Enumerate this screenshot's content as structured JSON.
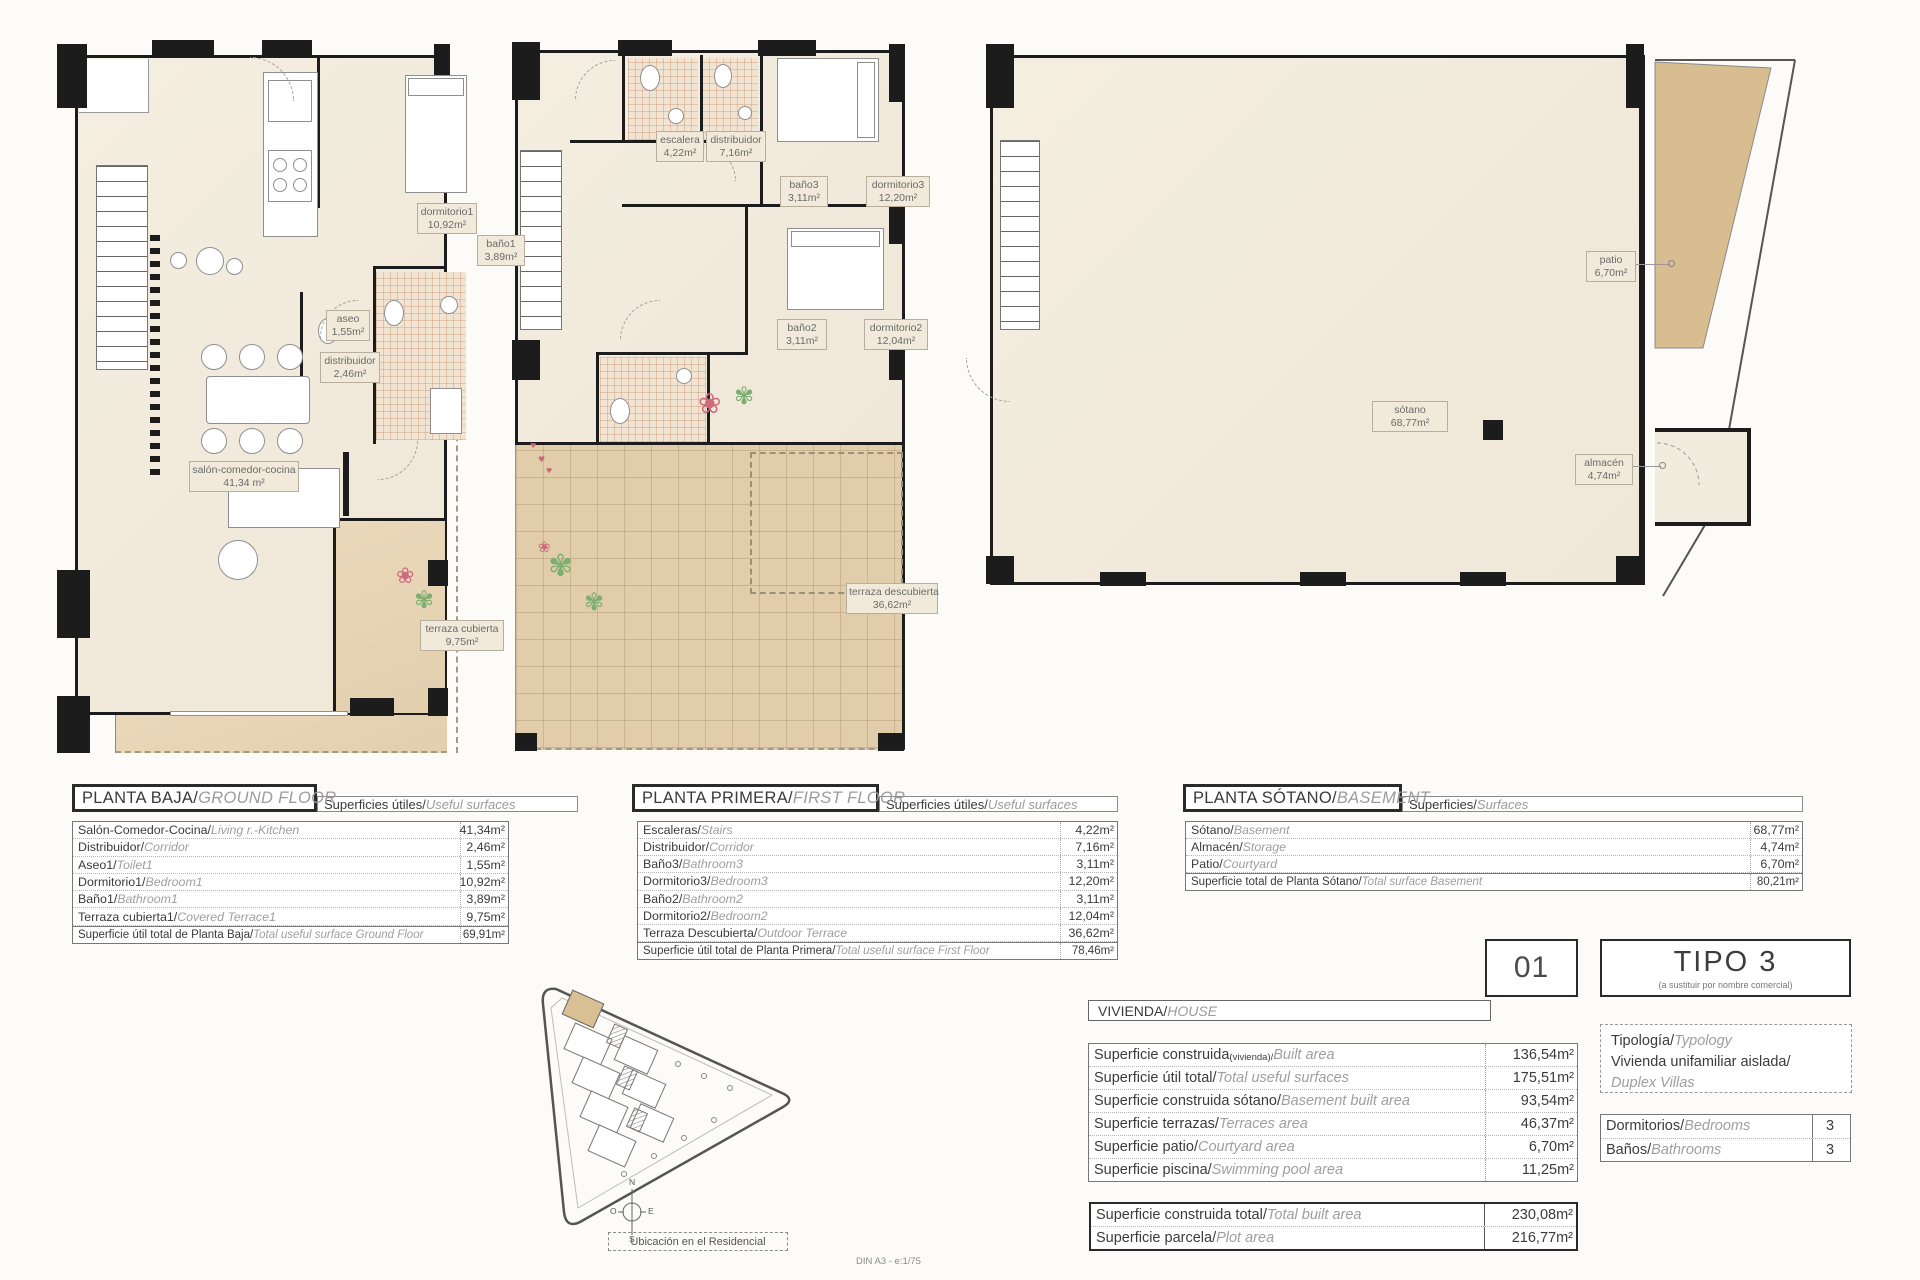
{
  "ground": {
    "title_es": "PLANTA BAJA/",
    "title_en": "GROUND FLOOR",
    "strip_es": "Superficies útiles/",
    "strip_en": "Useful surfaces",
    "labels": [
      {
        "name": "dormitorio1",
        "area": "10,92m²"
      },
      {
        "name": "baño1",
        "area": "3,89m²"
      },
      {
        "name": "aseo",
        "area": "1,55m²"
      },
      {
        "name": "distribuidor",
        "area": "2,46m²"
      },
      {
        "name": "salón-comedor-cocina",
        "area": "41,34 m²"
      },
      {
        "name": "terraza cubierta",
        "area": "9,75m²"
      }
    ],
    "rows": [
      {
        "es": "Salón-Comedor-Cocina/",
        "en": "Living r.-Kitchen",
        "value": "41,34m²"
      },
      {
        "es": "Distribuidor/",
        "en": "Corridor",
        "value": "2,46m²"
      },
      {
        "es": "Aseo1/",
        "en": "Toilet1",
        "value": "1,55m²"
      },
      {
        "es": "Dormitorio1/",
        "en": "Bedroom1",
        "value": "10,92m²"
      },
      {
        "es": "Baño1/",
        "en": "Bathroom1",
        "value": "3,89m²"
      },
      {
        "es": "Terraza cubierta1/",
        "en": "Covered Terrace1",
        "value": "9,75m²"
      }
    ],
    "total": {
      "es": "Superficie útil total de Planta Baja/",
      "en": "Total useful surface Ground Floor",
      "value": "69,91m²"
    }
  },
  "first": {
    "title_es": "PLANTA PRIMERA/",
    "title_en": "FIRST FLOOR",
    "strip_es": "Superficies útiles/",
    "strip_en": "Useful surfaces",
    "labels": [
      {
        "name": "escalera",
        "area": "4,22m²"
      },
      {
        "name": "distribuidor",
        "area": "7,16m²"
      },
      {
        "name": "baño3",
        "area": "3,11m²"
      },
      {
        "name": "dormitorio3",
        "area": "12,20m²"
      },
      {
        "name": "baño2",
        "area": "3,11m²"
      },
      {
        "name": "dormitorio2",
        "area": "12,04m²"
      },
      {
        "name": "terraza descubierta",
        "area": "36,62m²"
      }
    ],
    "rows": [
      {
        "es": "Escaleras/",
        "en": "Stairs",
        "value": "4,22m²"
      },
      {
        "es": "Distribuidor/",
        "en": "Corridor",
        "value": "7,16m²"
      },
      {
        "es": "Baño3/",
        "en": "Bathroom3",
        "value": "3,11m²"
      },
      {
        "es": "Dormitorio3/",
        "en": "Bedroom3",
        "value": "12,20m²"
      },
      {
        "es": "Baño2/",
        "en": "Bathroom2",
        "value": "3,11m²"
      },
      {
        "es": "Dormitorio2/",
        "en": "Bedroom2",
        "value": "12,04m²"
      },
      {
        "es": "Terraza Descubierta/",
        "en": "Outdoor Terrace",
        "value": "36,62m²"
      }
    ],
    "total": {
      "es": "Superficie útil total de Planta Primera/",
      "en": "Total useful surface First Floor",
      "value": "78,46m²"
    }
  },
  "basement": {
    "title_es": "PLANTA SÓTANO/",
    "title_en": "BASEMENT",
    "strip_es": "Superficies/",
    "strip_en": "Surfaces",
    "labels": [
      {
        "name": "sótano",
        "area": "68,77m²"
      },
      {
        "name": "almacén",
        "area": "4,74m²"
      },
      {
        "name": "patio",
        "area": "6,70m²"
      }
    ],
    "rows": [
      {
        "es": "Sótano/",
        "en": "Basement",
        "value": "68,77m²"
      },
      {
        "es": "Almacén/",
        "en": "Storage",
        "value": "4,74m²"
      },
      {
        "es": "Patio/",
        "en": "Courtyard",
        "value": "6,70m²"
      }
    ],
    "total": {
      "es": "Superficie total de Planta Sótano/",
      "en": "Total surface Basement",
      "value": "80,21m²"
    }
  },
  "summary": {
    "unit_number": "01",
    "type_title": "TIPO 3",
    "type_subtitle": "(a sustituir por nombre comercial)",
    "vivienda_es": "VIVIENDA/",
    "vivienda_en": "HOUSE",
    "rows": [
      {
        "es": "Superficie construida",
        "small": "(vivienda)/",
        "en": "Built area",
        "value": "136,54m²"
      },
      {
        "es": "Superficie útil total/",
        "small": "",
        "en": "Total useful surfaces",
        "value": "175,51m²"
      },
      {
        "es": "Superficie construida sótano/",
        "small": "",
        "en": "Basement built area",
        "value": "93,54m²"
      },
      {
        "es": "Superficie terrazas/",
        "small": "",
        "en": "Terraces area",
        "value": "46,37m²"
      },
      {
        "es": "Superficie patio/",
        "small": "",
        "en": "Courtyard area",
        "value": "6,70m²"
      },
      {
        "es": "Superficie piscina/",
        "small": "",
        "en": "Swimming pool area",
        "value": "11,25m²"
      }
    ],
    "totals": [
      {
        "es": "Superficie construida total/",
        "en": "Total built area",
        "value": "230,08m²"
      },
      {
        "es": "Superficie parcela/",
        "en": "Plot area",
        "value": "216,77m²"
      }
    ],
    "typology_label_es": "Tipología/",
    "typology_label_en": "Typology",
    "typology_value_es": "Vivienda unifamiliar aislada/",
    "typology_value_en": "Duplex Villas",
    "rooms": [
      {
        "es": "Dormitorios/",
        "en": "Bedrooms",
        "value": "3"
      },
      {
        "es": "Baños/",
        "en": "Bathrooms",
        "value": "3"
      }
    ]
  },
  "site": {
    "caption": "Ubicación en el Residencial",
    "compass_n": "N",
    "compass_e": "E",
    "compass_s": "S",
    "compass_o": "O"
  },
  "footer_note": "DIN A3 - e:1/75"
}
